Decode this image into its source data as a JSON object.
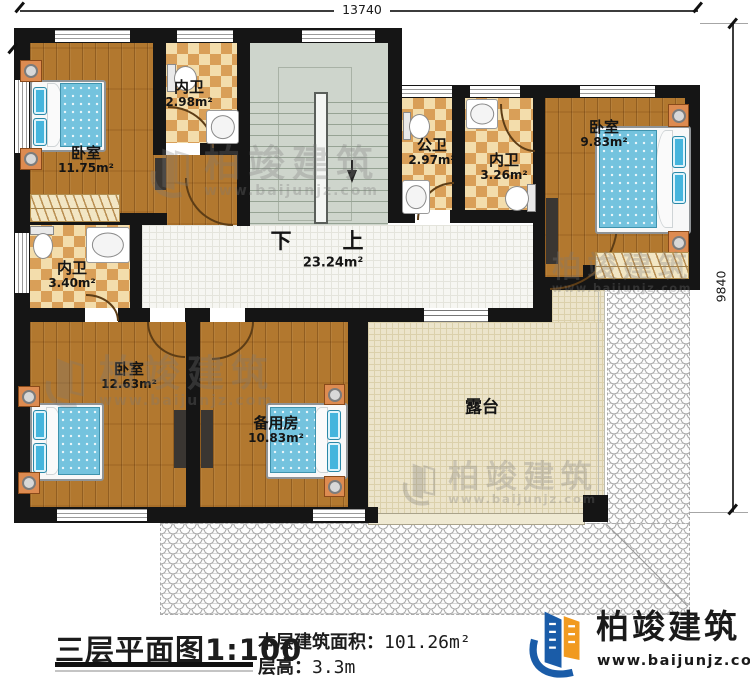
{
  "dimensions": {
    "top_width": "13740",
    "right_depth": "9840"
  },
  "stairs": {
    "down_label": "下",
    "up_label": "上",
    "hall_area": "23.24m²"
  },
  "rooms": [
    {
      "name": "卧室",
      "area": "11.75m²"
    },
    {
      "name": "内卫",
      "area": "2.98m²"
    },
    {
      "name": "公卫",
      "area": "2.97m²"
    },
    {
      "name": "内卫",
      "area": "3.26m²"
    },
    {
      "name": "卧室",
      "area": "9.83m²"
    },
    {
      "name": "内卫",
      "area": "3.40m²"
    },
    {
      "name": "卧室",
      "area": "12.63m²"
    },
    {
      "name": "备用房",
      "area": "10.83m²"
    },
    {
      "name": "露台",
      "area": ""
    }
  ],
  "title_block": {
    "plan_title": "三层平面图1:100",
    "area_label": "本层建筑面积：",
    "area_value": "101.26m²",
    "height_label": "层高：",
    "height_value": "3.3m"
  },
  "brand": {
    "name": "柏竣建筑",
    "website": "www.baijunjz.com"
  },
  "watermark": {
    "name": "柏竣建筑",
    "website": "www.baijunjz.com"
  },
  "colors": {
    "wall": "#151515",
    "wood_floor": "#b2782f",
    "checker_dark": "#d99f58",
    "checker_light": "#f3ddac",
    "stair": "#ced5cc",
    "hall_tile": "#f6f6f2",
    "terrace": "#ece4cb",
    "bed_blue": "#74c3de",
    "pillow_blue": "#45b5dd",
    "nightstand_orange": "#dd8b51",
    "logo_blue": "#1a5ca8",
    "logo_orange": "#f19a1f"
  }
}
